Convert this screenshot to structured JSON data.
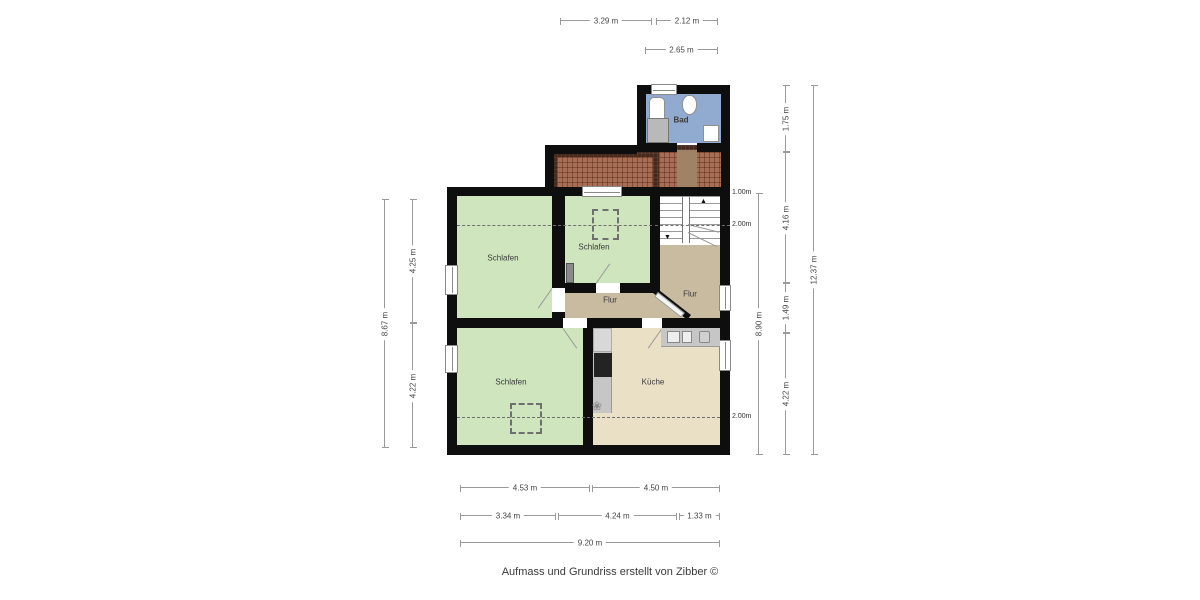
{
  "rooms": {
    "bad": "Bad",
    "schlafen_nw": "Schlafen",
    "schlafen_n": "Schlafen",
    "flur_w": "Flur",
    "flur_e": "Flur",
    "schlafen_sw": "Schlafen",
    "kueche": "Küche"
  },
  "dims": {
    "top": [
      "3.29 m",
      "2.12 m",
      "2.65 m"
    ],
    "left": [
      "4.25 m",
      "8.67 m",
      "4.22 m"
    ],
    "right": [
      "1.75 m",
      "4.16 m",
      "1.49 m",
      "4.22 m",
      "8.90 m",
      "12.37 m"
    ],
    "bottom": [
      "4.53 m",
      "4.50 m",
      "3.34 m",
      "4.24 m",
      "1.33 m",
      "9.20 m"
    ],
    "heights": [
      "1.00m",
      "2.00m",
      "2.00m"
    ]
  },
  "icons": {
    "up_arrow": "▲",
    "down_arrow": "▼",
    "plant": "❀"
  },
  "footer": "Aufmass und Grundriss erstellt von Zibber ©",
  "colors": {
    "wall": "#0e0e0e",
    "bedroom": "#cfe5bd",
    "hallway": "#c9bb9f",
    "kitchen": "#eae0c6",
    "bathroom": "#90aad0",
    "roof_dark": "#46291b",
    "roof_brick": "#a86d55"
  }
}
